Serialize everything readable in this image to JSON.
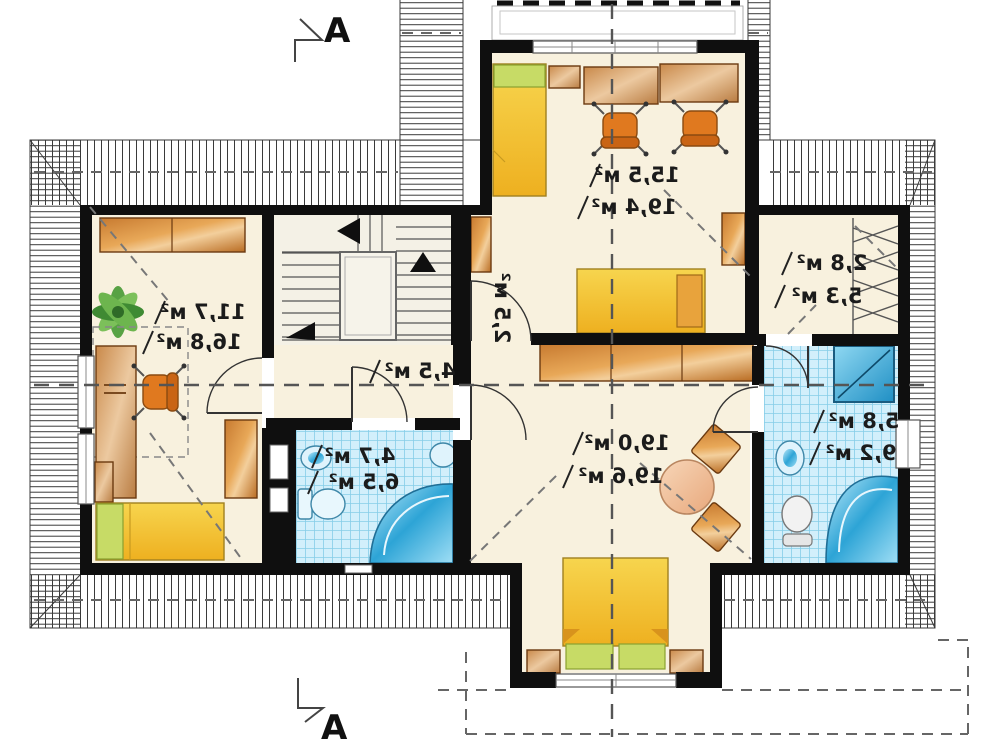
{
  "plan": {
    "type": "attic floor plan",
    "section_letter_top": "A",
    "section_letter_bottom": "A",
    "rooms": {
      "top_room": {
        "area_upper": "15,5 м²",
        "area_lower": "19,4 м²"
      },
      "left_room": {
        "area_upper": "11,7 м²",
        "area_lower": "16,8 м²"
      },
      "hall": {
        "area": "4,5 м²"
      },
      "stairs": {
        "area": "2,5 м²"
      },
      "bath_small": {
        "area_upper": "4,7 м²",
        "area_lower": "6,5 м²"
      },
      "master_room": {
        "area_upper": "19,0 м²",
        "area_lower": "19,6 м²"
      },
      "closet": {
        "area_upper": "2,8 м²",
        "area_lower": "5,3 м²"
      },
      "bath_large": {
        "area_upper": "5,8 м²",
        "area_lower": "9,2 м²"
      }
    },
    "colors": {
      "wall": "#0f0f0f",
      "floor": "#f8f1de",
      "tile": "#d2effb",
      "tile-grid": "#86cde8",
      "wood": "#d98a3f",
      "bed-yellow": "#f2c232",
      "pillow-green": "#c7db66",
      "fixture-blue": "#2da4d6",
      "roof-line": "#3a3a3a",
      "dash": "#666666"
    }
  }
}
